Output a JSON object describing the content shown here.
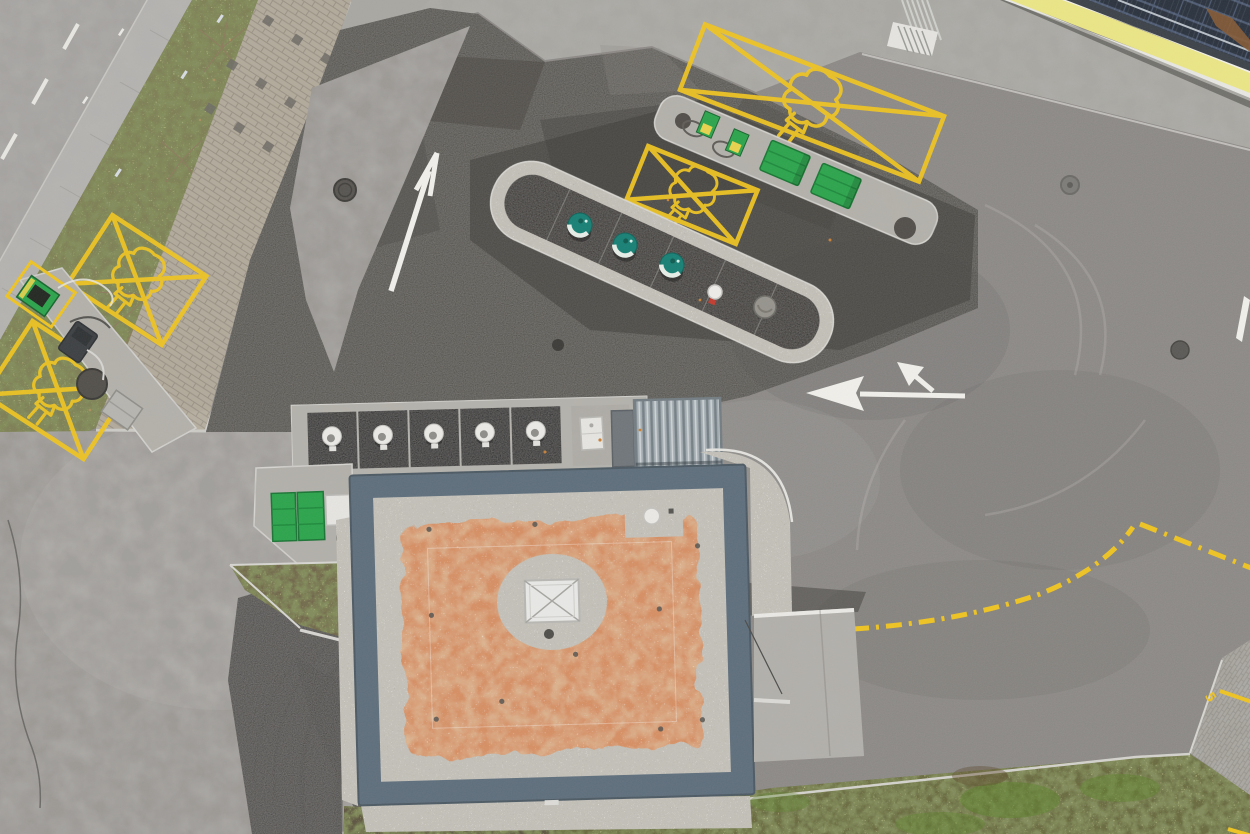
{
  "scene": {
    "title": "Aerial drone view of an EV fast-charging station site with building, charging islands and marked parking bays",
    "colors": {
      "asphalt_base": "#8a8784",
      "asphalt_dark": "#55524e",
      "asphalt_patch": "#47443f",
      "asphalt_light": "#9c9995",
      "road_surface": "#a5a3a0",
      "sidewalk": "#b6b4b1",
      "apron": "#a9a7a2",
      "paver": "#b2aa9b",
      "paver_dark": "#6e6b65",
      "paver_corner": "#a7a49e",
      "grass_strip": "#7d7e52",
      "grass_south": "#67693d",
      "soil": "#5c523f",
      "dirt_patch": "#6f6549",
      "gravel": "#c3c0b8",
      "island_surface": "#34322f",
      "island_concrete": "#b4b1aa",
      "building_border": "#5d6d7b",
      "roof_orange": "#d78e62",
      "skylight": "#e9e9e7",
      "corrugated": "#a3adb2",
      "marking_yellow": "#f0c41f",
      "marking_white": "#f2f1ec",
      "ev_green": "#2aa44b",
      "pillar_yellow": "#e9d44b",
      "teal": "#157f74",
      "canopy_yellow": "#ece785",
      "canopy_frame": "#3a4047",
      "solar_blue": "#28303d",
      "solar_line": "#4d5a72",
      "concrete_ramp": "#b2afaa",
      "white_box": "#e7e6e2",
      "rust": "#8a5a33",
      "skid": "#3a3835"
    },
    "objects": {
      "ev_parking_boxes": 4,
      "charge_pedestals": 3,
      "charging_pillars": 2,
      "green_containers": 2,
      "green_cabinets": 2,
      "service_pads": 5
    }
  },
  "markings": {
    "ramp_number": "5"
  }
}
